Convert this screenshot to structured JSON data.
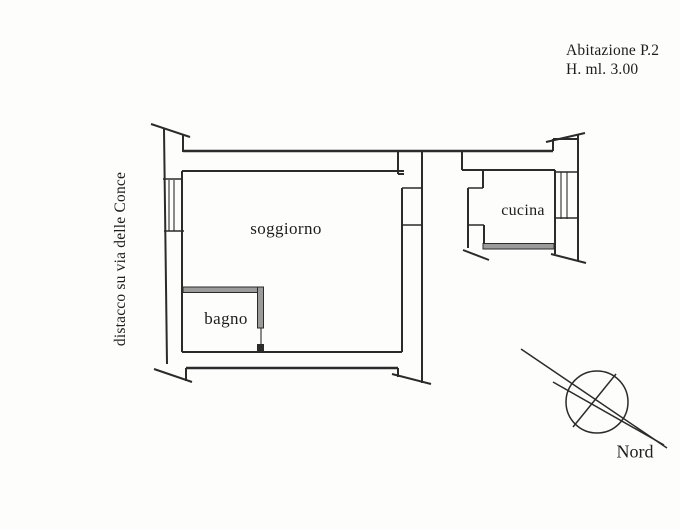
{
  "title_block": {
    "line1": "Abitazione  P.2",
    "line2": "H.  ml. 3.00"
  },
  "boundary_note": "distacco su via delle Conce",
  "rooms": {
    "living": "soggiorno",
    "bath": "bagno",
    "kitchen": "cucina"
  },
  "compass": {
    "label": "Nord"
  },
  "colors": {
    "ink": "#2b2b2b",
    "hatch": "#9b9b9b",
    "paper": "#fdfdfc"
  }
}
